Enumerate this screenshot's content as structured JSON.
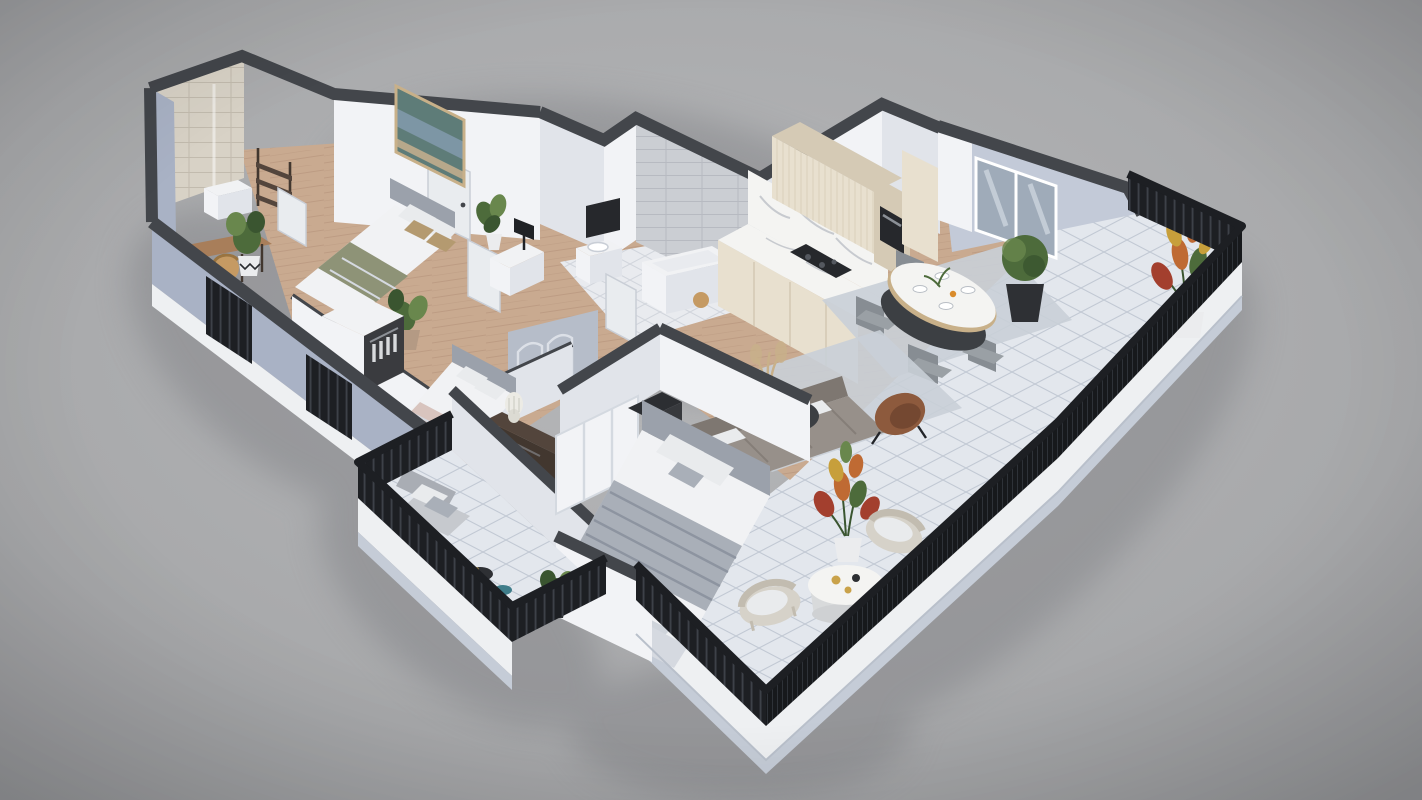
{
  "meta": {
    "type": "3d-floorplan-isometric-render",
    "view": "axonometric",
    "visible_text": []
  },
  "palette": {
    "bg_top": "#b6b7b9",
    "bg_edge": "#96979a",
    "wall_cap": "#43464b",
    "wall_white": "#f2f3f6",
    "wall_white_shade": "#e1e4ea",
    "wall_blue": "#a9b2c5",
    "wall_blue_light": "#c3cad8",
    "wall_blue_shade": "#8f98ae",
    "floor_wood": "#c9aa90",
    "floor_wood_line": "#b28f78",
    "tile_terrace": "#e3e7ed",
    "tile_terrace_line": "#c2c9d4",
    "tile_bath": "#e9ebef",
    "tile_bath_line": "#d2d6dd",
    "tile_gray_wall": "#cbced3",
    "tile_gray_line": "#b7bac1",
    "tile_beige_wall": "#d8d2c6",
    "tile_beige_line": "#c2bbae",
    "railing_black": "#1d1f23",
    "railing_bar": "#585d66",
    "mesh_dark": "#17191c",
    "mesh_line": "#34383f",
    "fascia": "#eef0f2",
    "fascia_shade": "#c5ccd7",
    "shadow": "#828387",
    "rug": "#c9cfd7",
    "rug_light": "#d8dce2",
    "sofa": "#97908a",
    "sofa_dark": "#7e7771",
    "pillow_white": "#e9ebed",
    "pillow_tan": "#b49a70",
    "blanket_olive": "#8e9377",
    "blanket_blush": "#d8c4be",
    "blanket_gray": "#a9afb8",
    "blanket_gray_line": "#8d94a0",
    "bed_white": "#f1f2f4",
    "bed_fold": "#d5d9e0",
    "headboard": "#9ba1ab",
    "wood_dark": "#53453c",
    "wood_darker": "#42372f",
    "table_black": "#3c3f43",
    "marble": "#f4f4f2",
    "marble_vein": "#c7cacf",
    "cream": "#e8e0cf",
    "cream_dark": "#d5cab5",
    "cream_rib": "#cfc4ad",
    "appliance": "#26282c",
    "leather": "#8d5a3d",
    "leather_dark": "#744831",
    "plant": "#4d6b3b",
    "plant_dark": "#3a5530",
    "plant_light": "#69874d",
    "croton_red": "#a33f2e",
    "croton_orange": "#bf6a33",
    "croton_yellow": "#c79f3b",
    "pot_white": "#ebecee",
    "pot_black": "#2e3034",
    "glass": "#9fabb9",
    "glass_light": "#c3cdd9",
    "painting_teal": "#5e7c78",
    "painting_blue": "#7d96a5",
    "painting_sand": "#b7a88b",
    "frame_tan": "#c8b089",
    "wicker": "#d6d2c9",
    "wicker_line": "#c2bcb0",
    "teal": "#3f7d8a",
    "gold": "#c9a24a",
    "orange": "#d98b2b",
    "tan_wood": "#a87e5a",
    "chair_tan": "#c59a63",
    "door_white": "#e9ecef",
    "arch_wall": "#b6bdc9",
    "arch_line": "#dce0e7",
    "lamp_black": "#202226",
    "chair_gray": "#9aa0a5",
    "chair_gray_dark": "#878d93"
  },
  "scene": {
    "setting": "studio gray backdrop",
    "rooms": [
      {
        "name": "bedroom-1",
        "furniture": [
          "double-bed",
          "upholstered-headboard",
          "wall-art",
          "nightstand",
          "black-table-lamp",
          "desk",
          "rattan-chair",
          "ladder-shelf",
          "monstera-plant",
          "zigzag-pot-plant",
          "white-door"
        ]
      },
      {
        "name": "shower-room",
        "furniture": [
          "beige-tiled-shower",
          "glass-screen",
          "washbasin"
        ]
      },
      {
        "name": "bathroom",
        "furniture": [
          "bathtub",
          "vanity-washbasin",
          "black-mirror",
          "gray-tiled-wall",
          "wicker-stool"
        ]
      },
      {
        "name": "hallway",
        "furniture": [
          "arch-pattern-wardrobe",
          "white-doors"
        ]
      },
      {
        "name": "bedroom-2",
        "furniture": [
          "double-bed",
          "open-wardrobe-with-clothes",
          "tv-console",
          "ribbed-table-lamp"
        ]
      },
      {
        "name": "master-bedroom",
        "furniture": [
          "king-bed",
          "gray-striped-throw",
          "sliding-wardrobe",
          "black-dresser",
          "foot-bench",
          "area-rug"
        ]
      },
      {
        "name": "kitchen",
        "furniture": [
          "cream-cabinet-run",
          "marble-counter",
          "marble-backsplash",
          "induction-cooktop",
          "built-in-oven-column",
          "floating-upper-cabinet"
        ]
      },
      {
        "name": "dining-area",
        "furniture": [
          "oval-marble-table",
          "black-pedestal",
          "four-fabric-chairs",
          "place-settings",
          "area-rug"
        ]
      },
      {
        "name": "living-area",
        "furniture": [
          "corner-sofa",
          "nesting-coffee-tables",
          "books",
          "leather-armchair",
          "pampas-vase",
          "area-rug",
          "glass-balustrade"
        ]
      },
      {
        "name": "wraparound-terrace",
        "furniture": [
          "diagonal-tile-floor",
          "black-metal-railing",
          "white-fascia",
          "croton-planter-north",
          "croton-planter-south",
          "boxwood-planter",
          "round-coffee-table",
          "two-wicker-lounge-chairs"
        ]
      },
      {
        "name": "balcony",
        "furniture": [
          "lounge-armchair",
          "black-side-table",
          "teal-side-table",
          "potted-plant",
          "black-metal-railing"
        ]
      },
      {
        "name": "exterior",
        "furniture": [
          "blue-gray-facade",
          "dark-parapet-caps",
          "louvered-shutters",
          "sliding-glass-door"
        ]
      }
    ]
  }
}
